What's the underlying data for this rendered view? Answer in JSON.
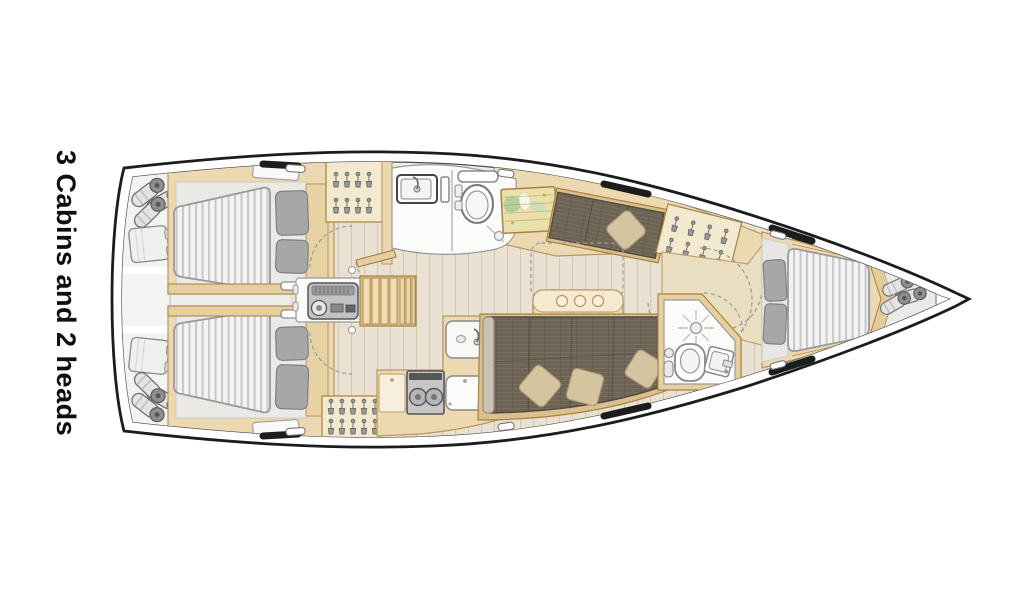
{
  "label": {
    "text": "3 Cabins and 2 heads"
  },
  "plan": {
    "type": "sailing-yacht-interior-floor-plan",
    "orientation": "bow-right",
    "cabins": 3,
    "heads": 2,
    "rooms": [
      {
        "name": "stern-lockers",
        "items": [
          "fenders",
          "folded-covers"
        ]
      },
      {
        "name": "aft-cabin-port",
        "items": [
          "double-berth",
          "two-pillows",
          "shelf-hatch",
          "wardrobe"
        ]
      },
      {
        "name": "aft-cabin-starboard",
        "items": [
          "double-berth",
          "two-pillows",
          "shelf-hatch",
          "wardrobe"
        ]
      },
      {
        "name": "companionway",
        "items": [
          "stairs",
          "engine-box"
        ]
      },
      {
        "name": "head-forward",
        "items": [
          "sink",
          "faucet",
          "toilet",
          "shower-drain",
          "door"
        ]
      },
      {
        "name": "saloon",
        "items": [
          "chart-table-with-map",
          "settee",
          "dining-table",
          "l-sofa",
          "three-cushions",
          "hanging-locker"
        ]
      },
      {
        "name": "galley",
        "items": [
          "two-burner-stove",
          "sink",
          "fridge",
          "counter"
        ]
      },
      {
        "name": "head-aft",
        "items": [
          "shower",
          "toilet",
          "sink",
          "toilet-paper"
        ]
      },
      {
        "name": "forward-cabin",
        "items": [
          "v-berth",
          "two-pillows",
          "side-shelves",
          "entry-doors"
        ]
      },
      {
        "name": "anchor-locker",
        "items": [
          "fenders",
          "bow-fitting"
        ]
      }
    ],
    "icons": [
      "hanger-icon",
      "fender-icon",
      "shower-icon",
      "toilet-icon",
      "sink-icon",
      "stove-burner-icon",
      "stairs-icon",
      "engine-icon",
      "door-swing-icon",
      "hull-window-icon",
      "deck-hatch-icon",
      "map-icon"
    ],
    "colors": {
      "hull-line": "#1c1c1c",
      "interior": "#ededec",
      "floor": "#e9e1d3",
      "floor-line": "#d5c7b2",
      "wood": "#ecd9b2",
      "wood-light": "#f3e9cf",
      "wood-dark": "#d9c08c",
      "wood-trim": "#b9965e",
      "trim-dark": "#a8823f",
      "mattress": "#f3f3f3",
      "mattress-stripe": "#c9c9c9",
      "pillow": "#a7a7a7",
      "sofa": "#6e6455",
      "sofa-line": "#7d7260",
      "cushion": "#d4c5a0",
      "room-white": "#fbfbfa",
      "metal": "#c2c2c2"
    }
  }
}
